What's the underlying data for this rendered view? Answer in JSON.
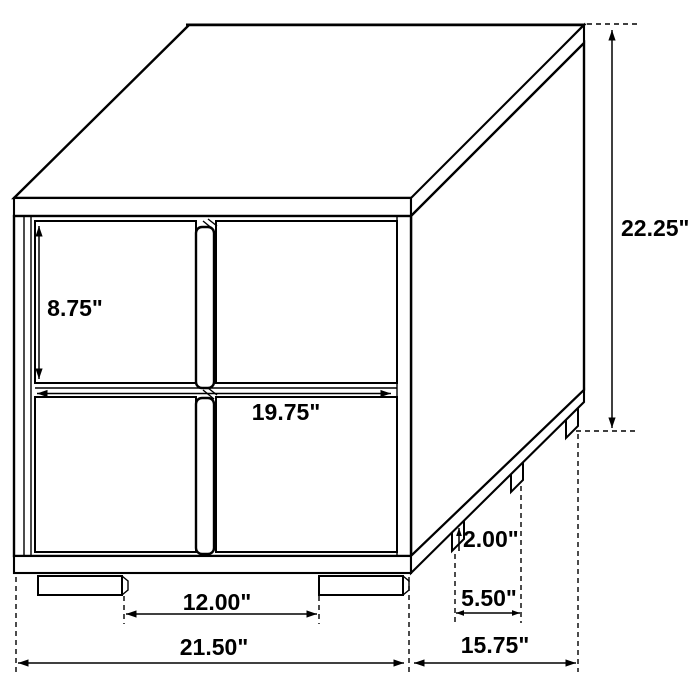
{
  "colors": {
    "background": "#ffffff",
    "line": "#000000",
    "text": "#000000"
  },
  "diagram": {
    "kind": "furniture-dimension-drawing",
    "labels": {
      "drawer_height": "8.75\"",
      "drawer_width": "19.75\"",
      "overall_height": "22.25\"",
      "foot_height": "2.00\"",
      "side_foot_spacing": "5.50\"",
      "front_foot_spacing": "12.00\"",
      "overall_width": "21.50\"",
      "overall_depth": "15.75\""
    }
  }
}
